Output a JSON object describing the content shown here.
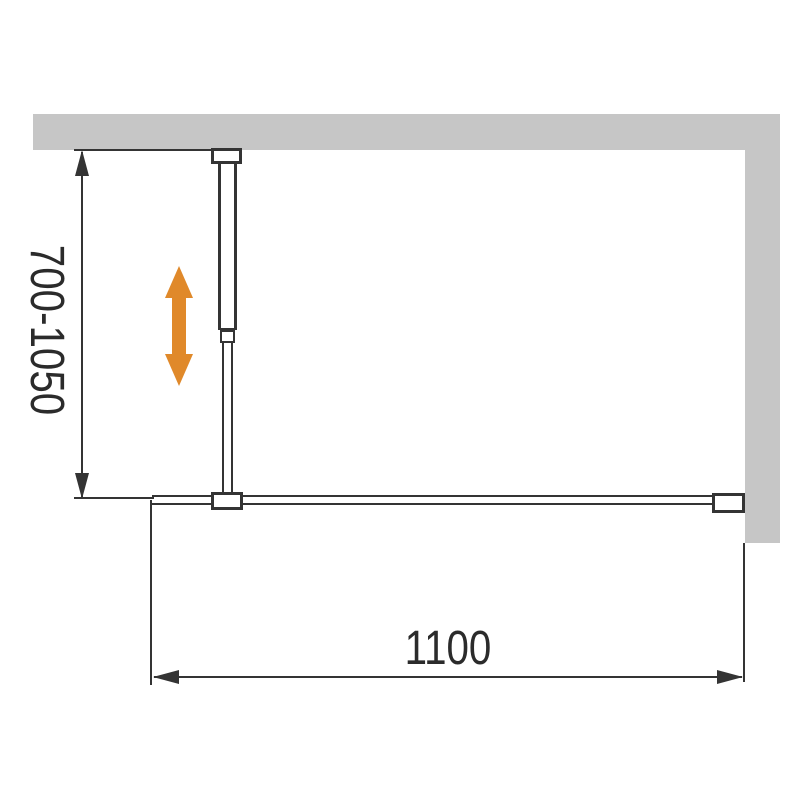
{
  "figure": {
    "dimension_vertical": {
      "label": "700-1050"
    },
    "dimension_horizontal": {
      "label": "1100"
    },
    "colors": {
      "wall": "#c6c6c6",
      "line": "#343434",
      "text": "#2b2b2b",
      "accent": "#e0892a"
    }
  }
}
